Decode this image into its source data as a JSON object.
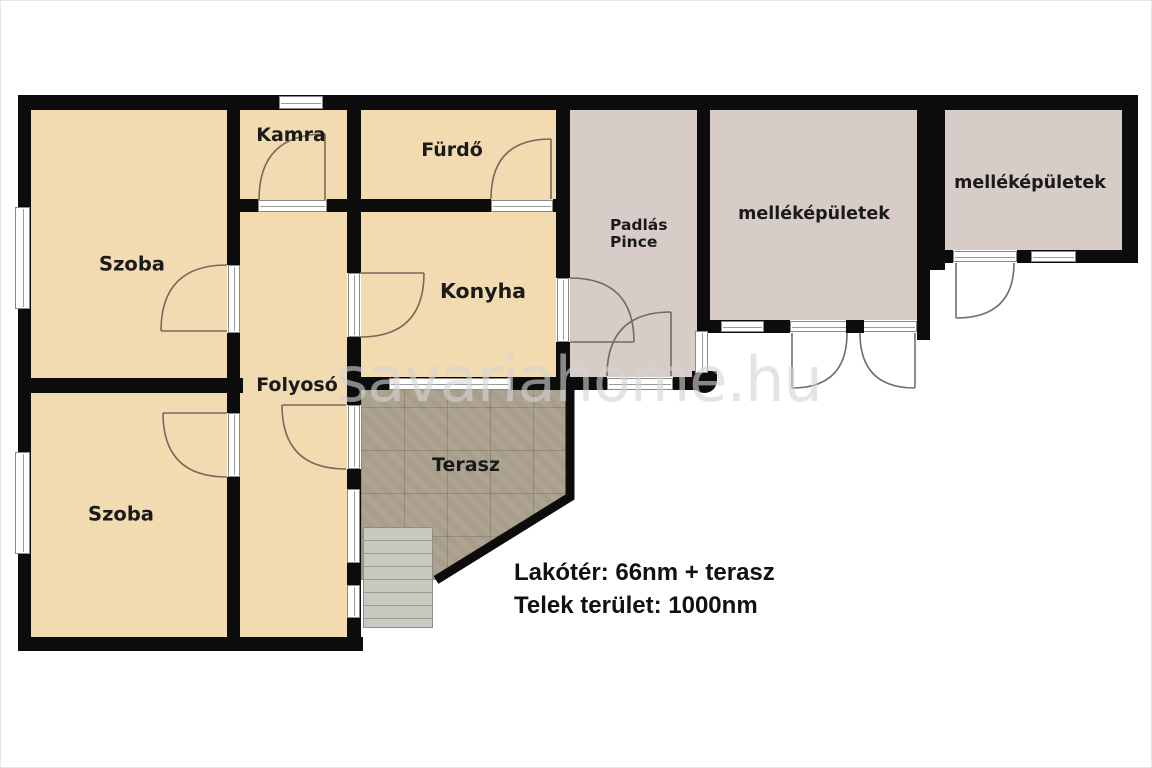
{
  "plan": {
    "rooms": {
      "szoba_top": {
        "label": "Szoba"
      },
      "szoba_bottom": {
        "label": "Szoba"
      },
      "kamra": {
        "label": "Kamra"
      },
      "furdo": {
        "label": "Fürdő"
      },
      "konyha": {
        "label": "Konyha"
      },
      "folyoso": {
        "label": "Folyosó"
      },
      "padlas_pince": {
        "line1": "Padlás",
        "line2": "Pince"
      },
      "terasz": {
        "label": "Terasz"
      },
      "mellekepulet_1": {
        "label": "melléképületek"
      },
      "mellekepulet_2": {
        "label": "melléképületek"
      }
    },
    "annotations": {
      "living_area": "Lakótér: 66nm + terasz",
      "plot_area": "Telek terület: 1000nm"
    },
    "watermark": "savariahome.hu",
    "colors": {
      "wall": "#0c0c0c",
      "room_fill": "#f2dbb0",
      "outbuilding_fill": "#d7ccc7",
      "terrace_fill": "#a89e8b",
      "stairs_fill": "#cac9c1"
    }
  }
}
